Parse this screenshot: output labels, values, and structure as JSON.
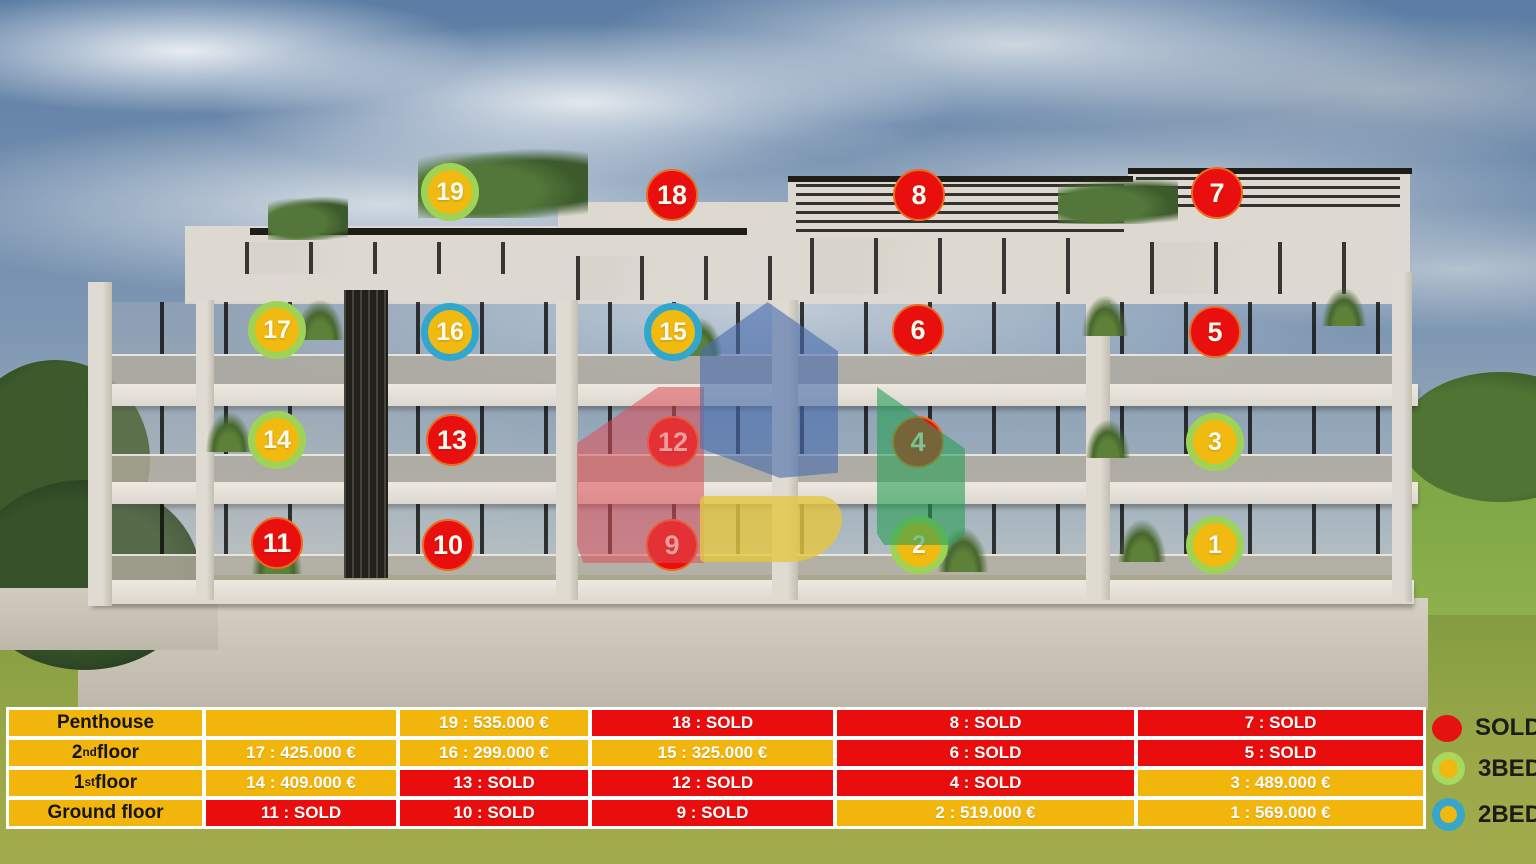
{
  "legend": [
    {
      "id": "sold",
      "label": "SOLD"
    },
    {
      "id": "bed3",
      "label": "3BED"
    },
    {
      "id": "bed2",
      "label": "2BED"
    }
  ],
  "table": {
    "floors": [
      {
        "label_main": "Penthouse",
        "label_sup": "",
        "label_rest": "",
        "cells": [
          {
            "text": "",
            "status": "available"
          },
          {
            "text": "19 : 535.000 €",
            "status": "available"
          },
          {
            "text": "18 : SOLD",
            "status": "sold"
          },
          {
            "text": "8 : SOLD",
            "status": "sold"
          },
          {
            "text": "7 : SOLD",
            "status": "sold"
          }
        ]
      },
      {
        "label_main": "2",
        "label_sup": "nd",
        "label_rest": " floor",
        "cells": [
          {
            "text": "17 : 425.000 €",
            "status": "available"
          },
          {
            "text": "16 : 299.000 €",
            "status": "available"
          },
          {
            "text": "15 : 325.000 €",
            "status": "available"
          },
          {
            "text": "6 : SOLD",
            "status": "sold"
          },
          {
            "text": "5 : SOLD",
            "status": "sold"
          }
        ]
      },
      {
        "label_main": "1",
        "label_sup": "st",
        "label_rest": " floor",
        "cells": [
          {
            "text": "14 : 409.000 €",
            "status": "available"
          },
          {
            "text": "13 : SOLD",
            "status": "sold"
          },
          {
            "text": "12 : SOLD",
            "status": "sold"
          },
          {
            "text": "4 : SOLD",
            "status": "sold"
          },
          {
            "text": "3 : 489.000 €",
            "status": "available"
          }
        ]
      },
      {
        "label_main": "Ground floor",
        "label_sup": "",
        "label_rest": "",
        "cells": [
          {
            "text": "11 : SOLD",
            "status": "sold"
          },
          {
            "text": "10 : SOLD",
            "status": "sold"
          },
          {
            "text": "9 : SOLD",
            "status": "sold"
          },
          {
            "text": "2 : 519.000 €",
            "status": "available"
          },
          {
            "text": "1 : 569.000 €",
            "status": "available"
          }
        ]
      }
    ]
  },
  "badges": [
    {
      "num": "19",
      "type": "bed3",
      "x": 450,
      "y": 192
    },
    {
      "num": "18",
      "type": "sold",
      "x": 672,
      "y": 195
    },
    {
      "num": "8",
      "type": "sold",
      "x": 919,
      "y": 195
    },
    {
      "num": "7",
      "type": "sold",
      "x": 1217,
      "y": 193
    },
    {
      "num": "17",
      "type": "bed3",
      "x": 277,
      "y": 330
    },
    {
      "num": "16",
      "type": "bed2",
      "x": 450,
      "y": 332
    },
    {
      "num": "15",
      "type": "bed2",
      "x": 673,
      "y": 332
    },
    {
      "num": "6",
      "type": "sold",
      "x": 918,
      "y": 330
    },
    {
      "num": "5",
      "type": "sold",
      "x": 1215,
      "y": 332
    },
    {
      "num": "14",
      "type": "bed3",
      "x": 277,
      "y": 440
    },
    {
      "num": "13",
      "type": "sold",
      "x": 452,
      "y": 440
    },
    {
      "num": "12",
      "type": "sold",
      "x": 673,
      "y": 442
    },
    {
      "num": "4",
      "type": "sold",
      "x": 918,
      "y": 442
    },
    {
      "num": "3",
      "type": "bed3",
      "x": 1215,
      "y": 442
    },
    {
      "num": "11",
      "type": "sold",
      "x": 277,
      "y": 543
    },
    {
      "num": "10",
      "type": "sold",
      "x": 448,
      "y": 545
    },
    {
      "num": "9",
      "type": "sold",
      "x": 672,
      "y": 545
    },
    {
      "num": "2",
      "type": "bed3",
      "x": 919,
      "y": 545
    },
    {
      "num": "1",
      "type": "bed3",
      "x": 1215,
      "y": 545
    }
  ],
  "colors": {
    "sold_red": "#e90d0d",
    "available_gold": "#f2b50b",
    "bed3_ring_green": "#9fd355",
    "bed2_ring_blue": "#32a7cd",
    "grid_white": "#ffffff"
  }
}
